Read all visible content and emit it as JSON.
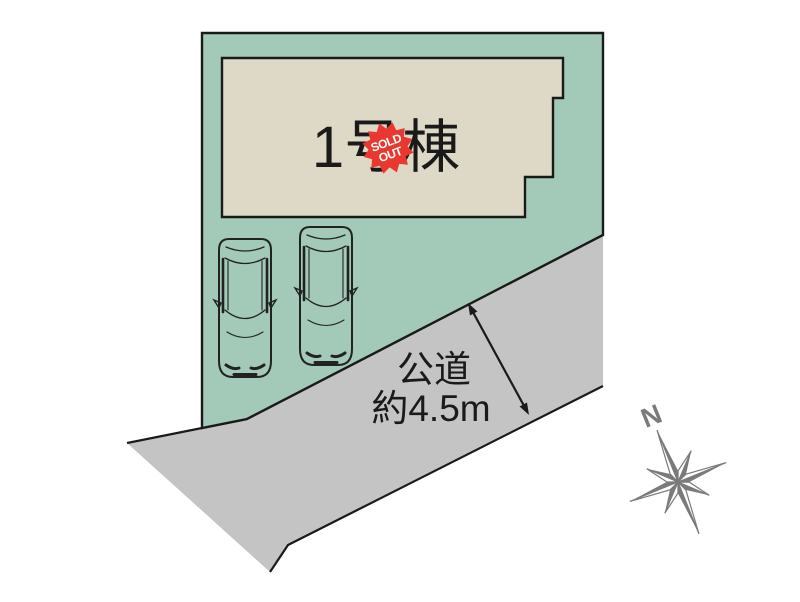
{
  "lot_plan": {
    "building": {
      "label": "1号棟"
    },
    "sold_badge": {
      "line1": "SOLD",
      "line2": "OUT"
    },
    "road": {
      "name": "公道",
      "width_note": "約4.5m"
    },
    "compass": {
      "north": "N"
    }
  },
  "colors": {
    "lot_fill": "#a3cab8",
    "building_fill": "#ded8c6",
    "road_fill": "#c4c4c4",
    "outline": "#1a1a1a",
    "badge_red": "#e8382f",
    "compass_gray": "#7a7a7a",
    "text": "#1a1a1a",
    "car_body": "#ffffff"
  }
}
